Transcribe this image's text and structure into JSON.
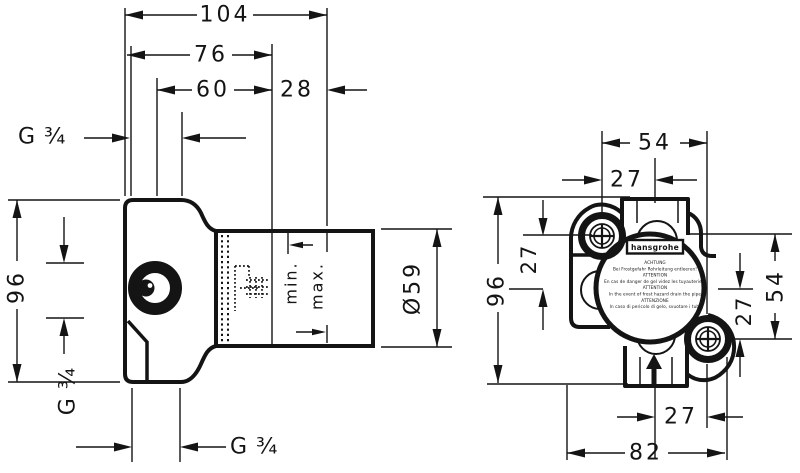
{
  "side_view": {
    "dim_total_depth": "104",
    "dim_depth_76": "76",
    "dim_depth_60": "60",
    "dim_depth_28": "28",
    "thread_top": "G ¾",
    "dim_height": "96",
    "thread_side": "G ¾",
    "thread_bottom": "G ¾",
    "label_min": "min.",
    "label_max": "max.",
    "dim_diameter": "Ø59"
  },
  "front_view": {
    "dim_screw_spacing_h": "54",
    "dim_top_offset": "27",
    "dim_height": "96",
    "dim_left_offset": "27",
    "dim_right_spacing": "54",
    "dim_right_offset": "27",
    "dim_bottom_offset": "27",
    "dim_width": "82",
    "badge": {
      "brand": "hansgrohe",
      "warning_lines": [
        "ACHTUNG",
        "Bei Frostgefahr Rohrleitung entleeren!",
        "ATTENTION",
        "En cas de danger de gel videz les tuyauteries!",
        "ATTENTION",
        "In the event of frost hazard drain the pipe",
        "ATTENZIONE",
        "In caso di pericolo di gelo, svuotare i tubi"
      ]
    }
  },
  "colors": {
    "ink": "#141414",
    "paper": "#ffffff"
  }
}
